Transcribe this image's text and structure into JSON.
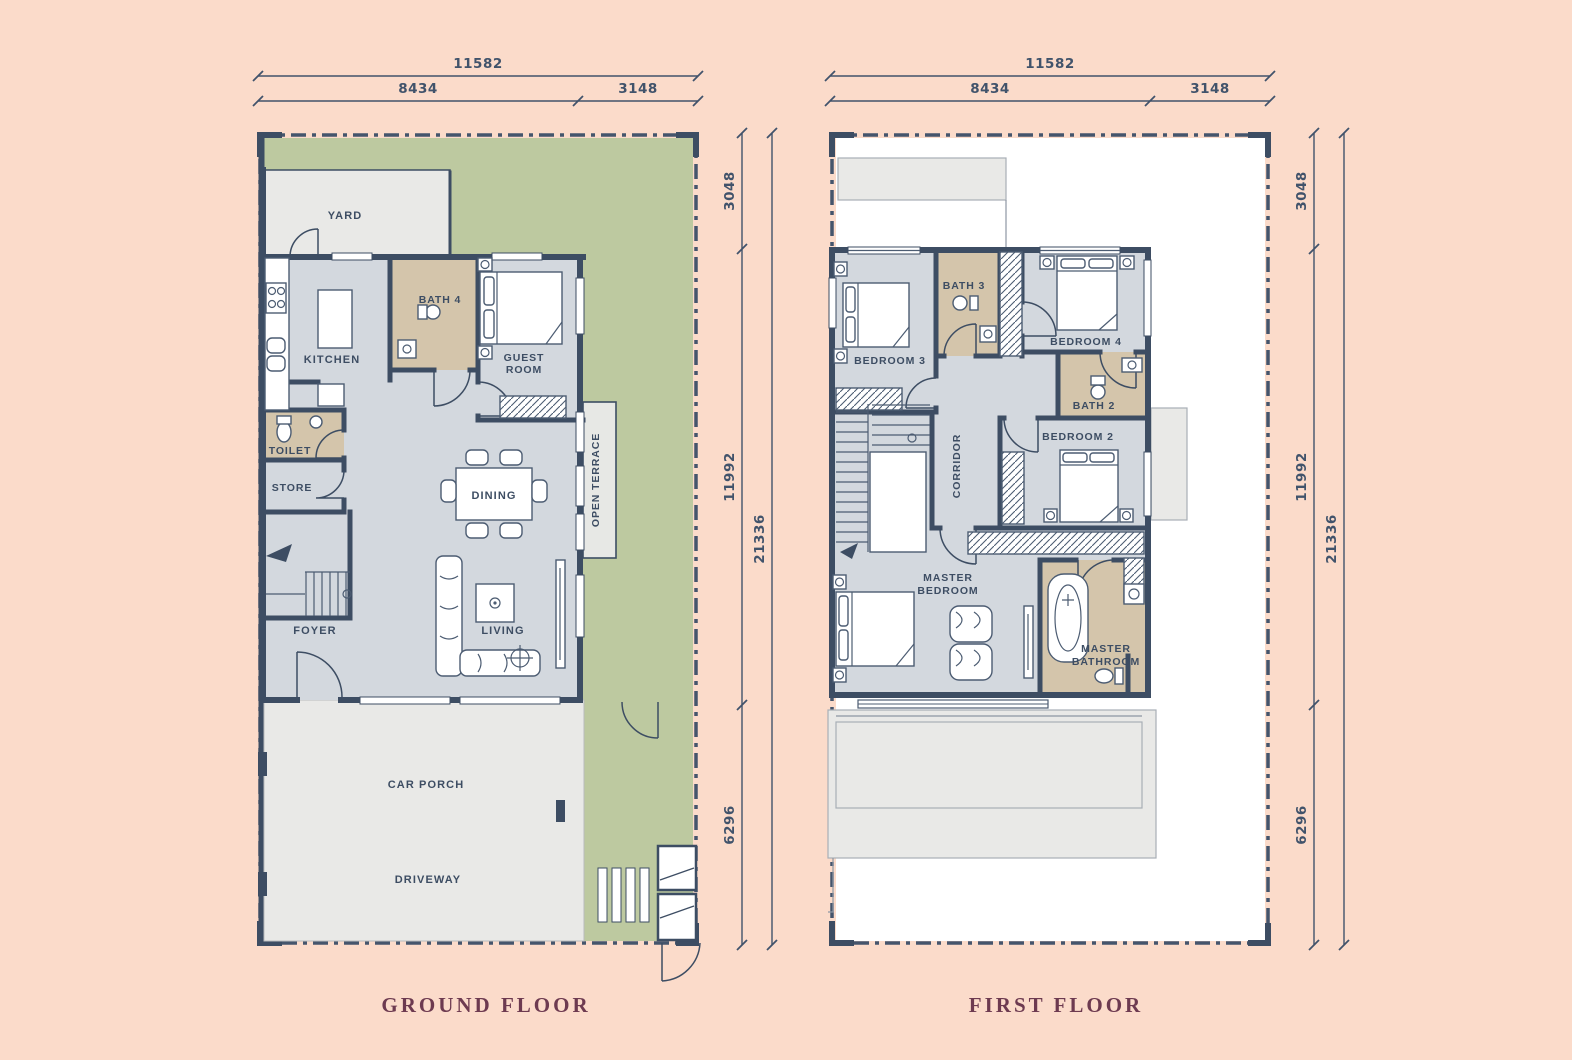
{
  "titles": {
    "ground_floor": "GROUND FLOOR",
    "first_floor": "FIRST FLOOR"
  },
  "dimensions": {
    "width_total": "11582",
    "width_main": "8434",
    "width_side": "3148",
    "depth_top": "3048",
    "depth_mid": "11992",
    "depth_bottom": "6296",
    "depth_total": "21336"
  },
  "ground_floor": {
    "yard": "YARD",
    "kitchen": "KITCHEN",
    "bath4": "BATH 4",
    "guest_room": [
      "GUEST",
      "ROOM"
    ],
    "toilet": "TOILET",
    "store": "STORE",
    "dining": "DINING",
    "open_terrace": "OPEN TERRACE",
    "foyer": "FOYER",
    "living": "LIVING",
    "car_porch": "CAR PORCH",
    "driveway": "DRIVEWAY"
  },
  "first_floor": {
    "bedroom3": "BEDROOM 3",
    "bath3": "BATH 3",
    "bedroom4": "BEDROOM 4",
    "bath2": "BATH 2",
    "bedroom2": "BEDROOM 2",
    "corridor": "CORRIDOR",
    "master_bedroom": [
      "MASTER",
      "BEDROOM"
    ],
    "master_bathroom": [
      "MASTER",
      "BATHROOM"
    ]
  },
  "palette": {
    "background": "#fbdbca",
    "wall": "#3d4d63",
    "floor": "#d3d8de",
    "bathroom": "#d4c5ab",
    "garden": "#bdc9a0",
    "paving": "#e9e9e7",
    "title_text": "#6d3a50"
  }
}
